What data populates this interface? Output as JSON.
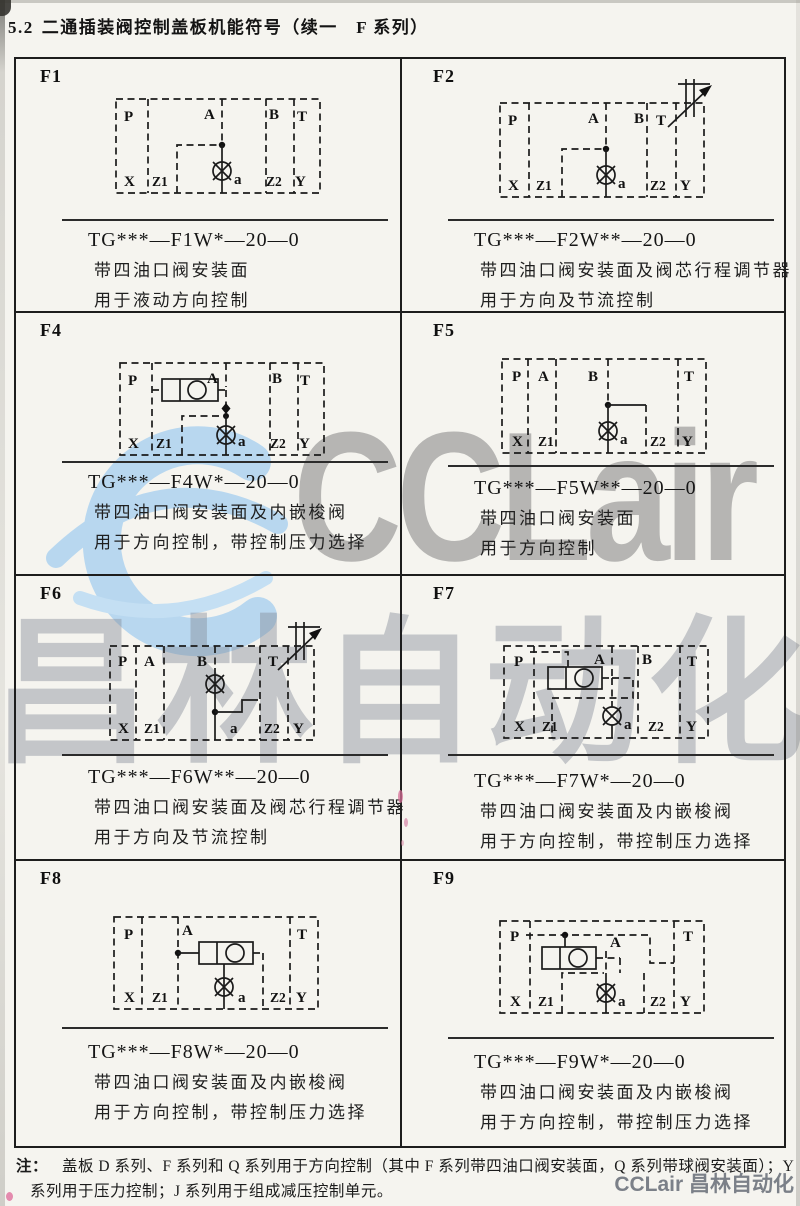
{
  "page": {
    "section_no": "5.2",
    "title": "二通插装阀控制盖板机能符号（续一　F 系列）",
    "note_label": "注：",
    "note_text": "盖板 D 系列、F 系列和 Q 系列用于方向控制（其中 F 系列带四油口阀安装面，Q 系列带球阀安装面）；Y 系列用于压力控制；J 系列用于组成减压控制单元。",
    "watermarks": {
      "big_text": "CCLair",
      "cn_text": "昌林自动化",
      "corner_text": "CCLair 昌林自动化",
      "light_blue": "#aed3f0",
      "gray": "#787878"
    }
  },
  "ports": {
    "P": "P",
    "A": "A",
    "B": "B",
    "T": "T",
    "X": "X",
    "Z1": "Z1",
    "Z2": "Z2",
    "Y": "Y",
    "a": "a"
  },
  "cells": [
    {
      "id": "F1",
      "model": "TG***—F1W*—20—0",
      "desc1": "带四油口阀安装面",
      "desc2": "用于液动方向控制"
    },
    {
      "id": "F2",
      "model": "TG***—F2W**—20—0",
      "desc1": "带四油口阀安装面及阀芯行程调节器",
      "desc2": "用于方向及节流控制"
    },
    {
      "id": "F4",
      "model": "TG***—F4W*—20—0",
      "desc1": "带四油口阀安装面及内嵌梭阀",
      "desc2": "用于方向控制，带控制压力选择"
    },
    {
      "id": "F5",
      "model": "TG***—F5W**—20—0",
      "desc1": "带四油口阀安装面",
      "desc2": "用于方向控制"
    },
    {
      "id": "F6",
      "model": "TG***—F6W**—20—0",
      "desc1": "带四油口阀安装面及阀芯行程调节器",
      "desc2": "用于方向及节流控制"
    },
    {
      "id": "F7",
      "model": "TG***—F7W*—20—0",
      "desc1": "带四油口阀安装面及内嵌梭阀",
      "desc2": "用于方向控制，带控制压力选择"
    },
    {
      "id": "F8",
      "model": "TG***—F8W*—20—0",
      "desc1": "带四油口阀安装面及内嵌梭阀",
      "desc2": "用于方向控制，带控制压力选择"
    },
    {
      "id": "F9",
      "model": "TG***—F9W*—20—0",
      "desc1": "带四油口阀安装面及内嵌梭阀",
      "desc2": "用于方向控制，带控制压力选择"
    }
  ]
}
